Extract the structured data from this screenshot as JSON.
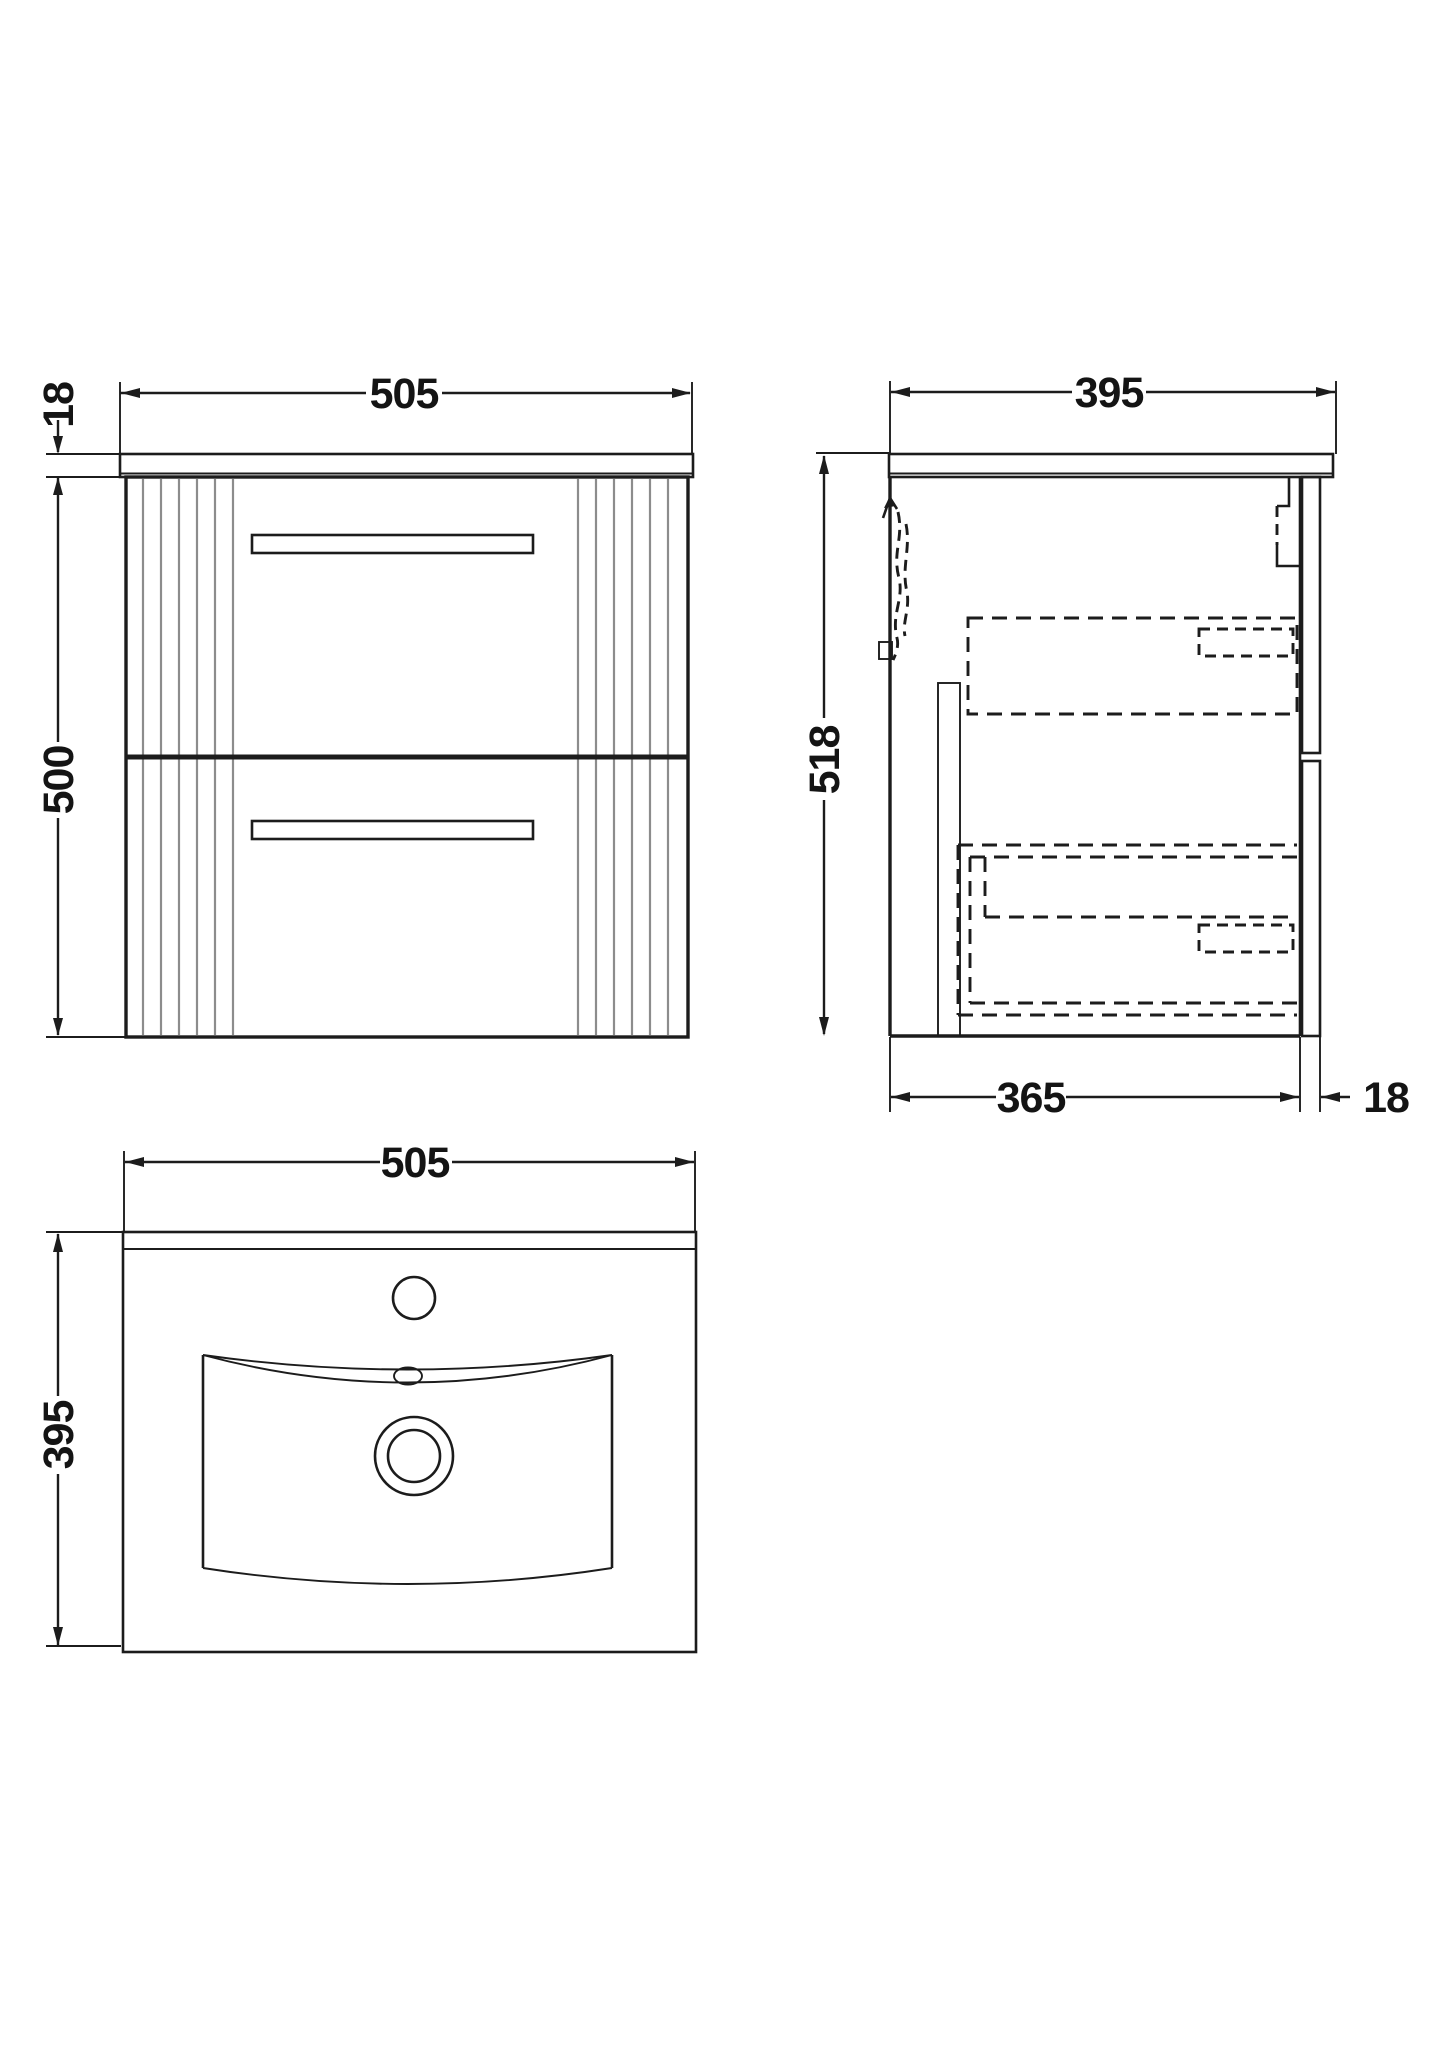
{
  "drawing_title": "wall-hung-vanity-unit-technical-drawing",
  "front_view": {
    "width_mm": "505",
    "worktop_thickness_mm": "18",
    "cabinet_height_mm": "500"
  },
  "side_view": {
    "depth_mm": "395",
    "overall_height_mm": "518",
    "body_depth_mm": "365",
    "drawer_front_thickness_mm": "18"
  },
  "basin_view": {
    "width_mm": "505",
    "depth_mm": "395"
  },
  "colors": {
    "line": "#1c1c1c",
    "flute_gray": "#8c8c8c",
    "background": "#ffffff"
  }
}
